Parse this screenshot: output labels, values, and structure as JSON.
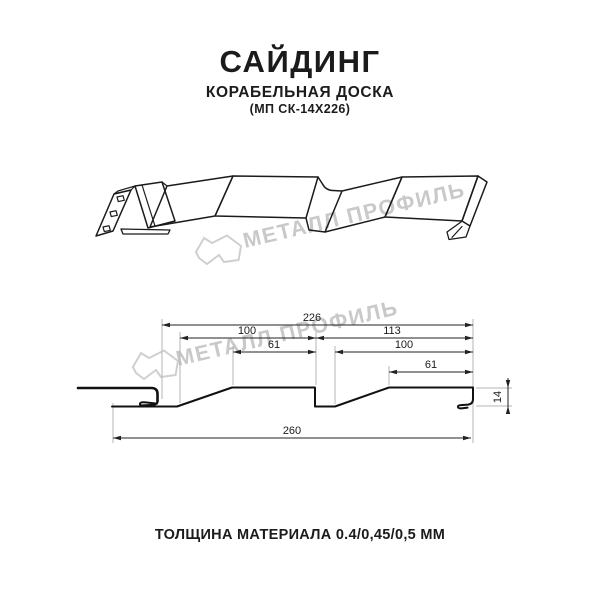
{
  "header": {
    "title": "САЙДИНГ",
    "subtitle": "КОРАБЕЛЬНАЯ ДОСКА",
    "model_code": "(МП СК-14Х226)"
  },
  "watermark": {
    "brand_text": "МЕТАЛЛ ПРОФИЛЬ",
    "logo_icon": "metall-profil-logo"
  },
  "cross_section": {
    "dimensions": {
      "overall_top": "226",
      "left_span": "100",
      "right_span": "113",
      "left_flat": "61",
      "right_inner_span": "100",
      "right_flat": "61",
      "bottom_total": "260",
      "profile_height": "14"
    }
  },
  "footer": {
    "thickness_label": "ТОЛЩИНА МАТЕРИАЛА 0.4/0,45/0,5 ММ"
  },
  "colors": {
    "ink": "#1b1b1b",
    "watermark_gray": "#c9c9c9",
    "extension_gray": "#b5b5b5",
    "background": "#ffffff"
  }
}
